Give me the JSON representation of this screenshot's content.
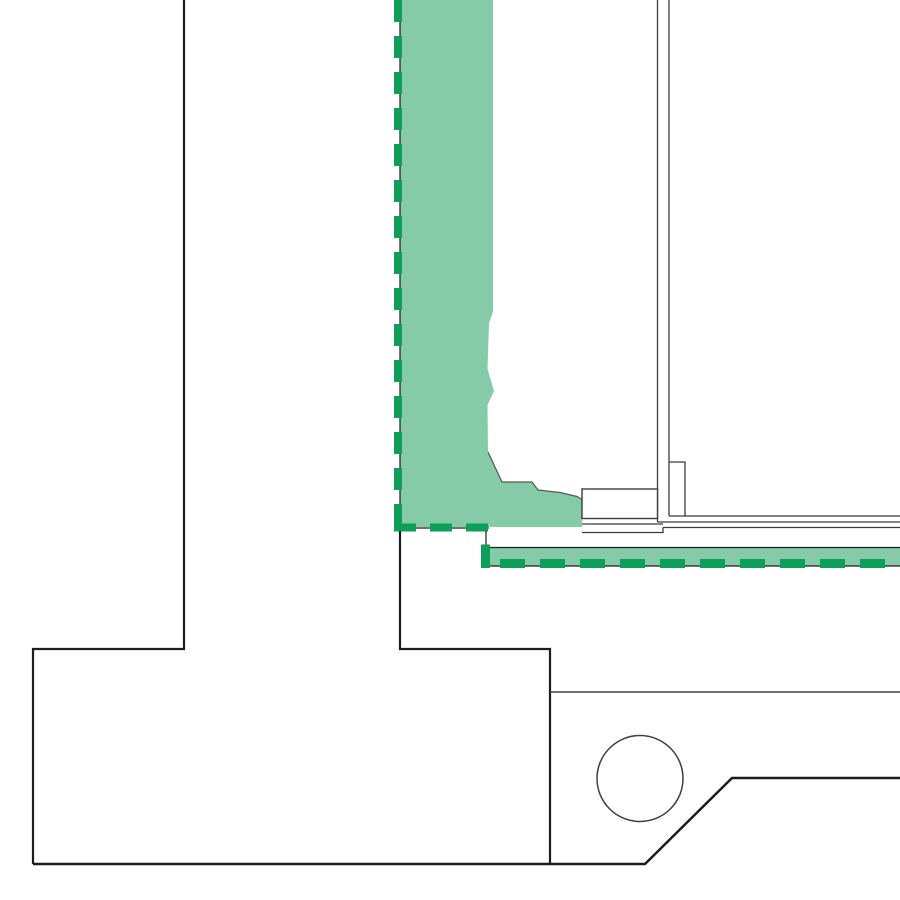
{
  "title": "",
  "colors": {
    "background": "#ffffff",
    "contour": "#1d1d1b",
    "contour_soft": "#3f3f3e",
    "frame_line": "#3c3c3b",
    "edge_line": "#575756",
    "insulation_fill": "#86cba7",
    "insulation_dash": "#0d9e58"
  },
  "drawing": {
    "kind": "architectural-detail-section",
    "elements": {
      "wall_footing": "stepped wall and foundation contour, left side",
      "plinth": "inner plinth contour with chamfered base and circular sleeve",
      "vertical_insulation": "green membrane strip with dashed marking, vertical",
      "horizontal_insulation": "green membrane strip with dashed marking, horizontal",
      "window_frame": "vertical frame profile lines, right side",
      "sill_block": "rectangular support block under frame"
    }
  }
}
